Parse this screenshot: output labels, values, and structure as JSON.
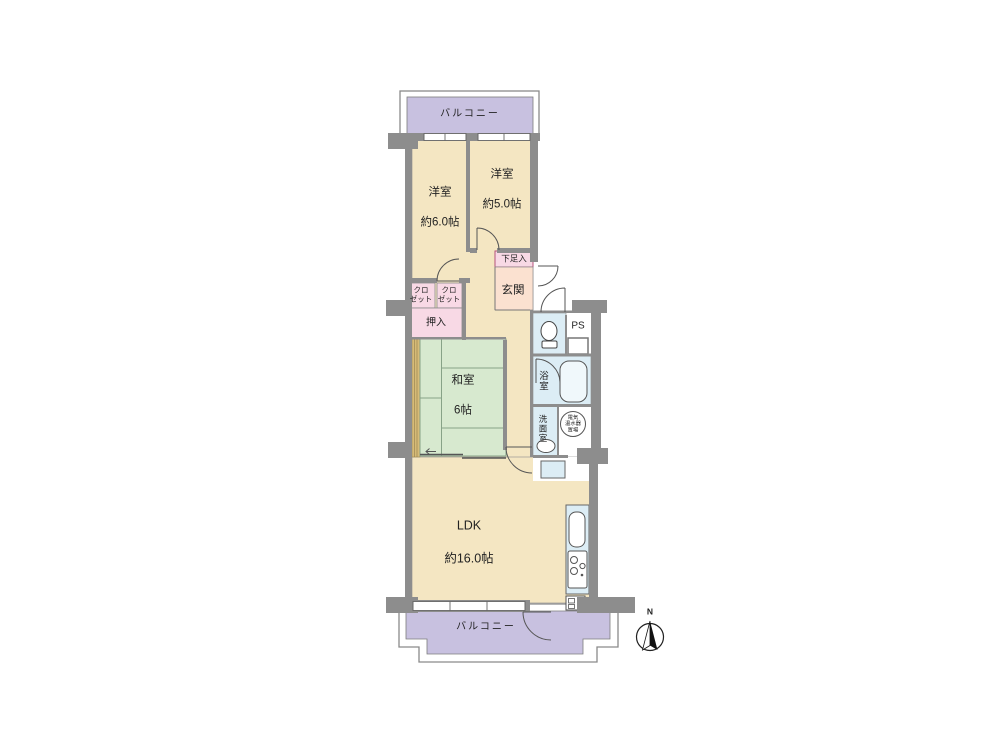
{
  "floor_plan": {
    "balcony_top": {
      "label": "バルコニー"
    },
    "balcony_bottom": {
      "label": "バルコニー"
    },
    "rooms": {
      "western1": {
        "name": "洋室",
        "size": "約6.0帖"
      },
      "western2": {
        "name": "洋室",
        "size": "約5.0帖"
      },
      "japanese": {
        "name": "和室",
        "size": "6帖"
      },
      "ldk": {
        "name": "LDK",
        "size": "約16.0帖"
      },
      "entrance": {
        "name": "玄関"
      },
      "shoe_box": {
        "name": "下足入"
      },
      "closet1": {
        "name": "クロ\nゼット"
      },
      "closet2": {
        "name": "クロ\nゼット"
      },
      "oshiire": {
        "name": "押入"
      },
      "ps": {
        "name": "PS"
      },
      "bathroom": {
        "name": "浴室"
      },
      "washroom": {
        "name": "洗面室"
      },
      "water_heater": {
        "name": "電気\n温水器\n置場"
      }
    },
    "compass": {
      "north_label": "N"
    },
    "colors": {
      "wall": "#8d8d8d",
      "room_floor": "#f4e6c2",
      "balcony": "#c8c1e0",
      "tatami": "#d7e9cf",
      "storage": "#f8d9e5",
      "entrance": "#fbe1d0",
      "water": "#dcedf5",
      "wood": "#d6bb78",
      "line": "#555555",
      "text": "#222222"
    }
  }
}
